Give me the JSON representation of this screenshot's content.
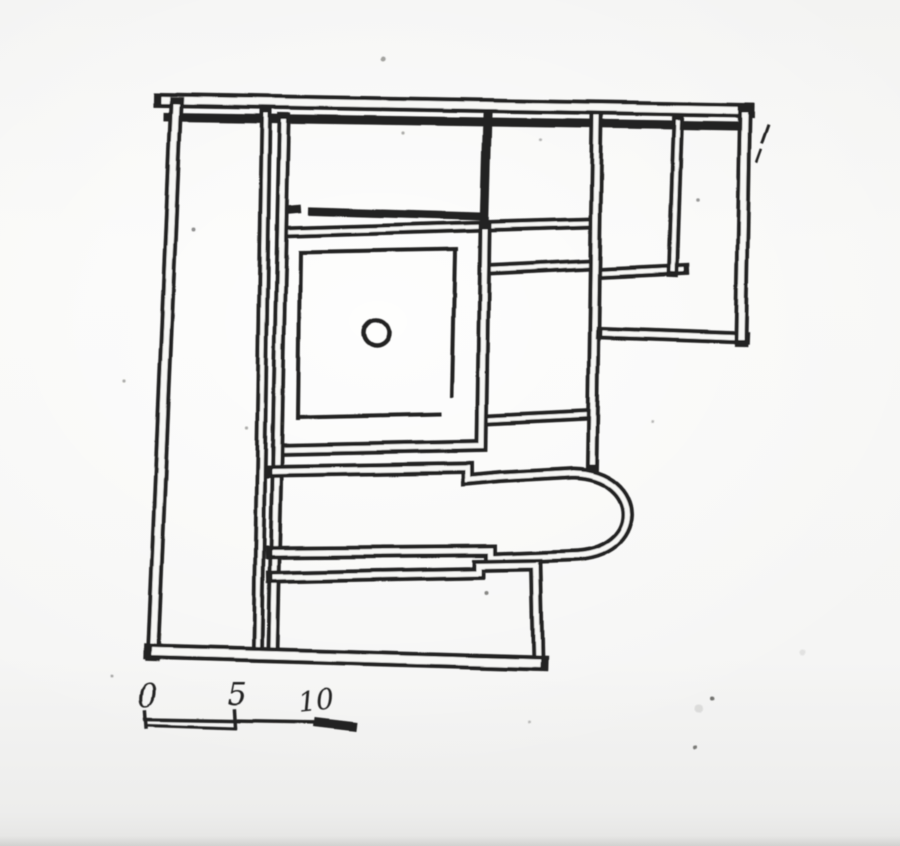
{
  "figure": {
    "kind": "scanned hand-drawn building floor plan",
    "paper_color": "#f7f7f5",
    "ink_color": "#242322"
  },
  "scale_bar": {
    "labels": [
      {
        "text": "0",
        "x": 149,
        "y": 706,
        "size": 31,
        "rot": -4
      },
      {
        "text": "5",
        "x": 238,
        "y": 705,
        "size": 31,
        "rot": 0
      },
      {
        "text": "10",
        "x": 316,
        "y": 710,
        "size": 28,
        "rot": -6
      }
    ],
    "lines": [
      {
        "d": "M 146,711 L 147,727",
        "w": 3.5
      },
      {
        "d": "M 235,711 L 236,727",
        "w": 3.5
      },
      {
        "d": "M 146,719 L 320,722",
        "w": 3.5
      },
      {
        "d": "M 147,725 L 236,728",
        "w": 3
      },
      {
        "d": "M 318,722 L 352,726",
        "w": 9
      }
    ]
  },
  "plan": {
    "walls": [
      {
        "d": "M 168,117 L 741,126",
        "w": 9,
        "h": 0
      },
      {
        "d": "M 487,115 L 484,229",
        "w": 9,
        "h": 0
      },
      {
        "d": "M 285,210 L 297,209",
        "w": 8,
        "h": 0
      },
      {
        "d": "M 312,211 L 481,216",
        "w": 8,
        "h": 0
      },
      {
        "d": "M 282,232 L 592,223",
        "w": 12,
        "h": 4
      },
      {
        "d": "M 489,269 L 592,264",
        "w": 12,
        "h": 4
      },
      {
        "d": "M 600,273 L 684,269",
        "w": 12,
        "h": 4
      },
      {
        "d": "M 678,120 L 673,271",
        "w": 12,
        "h": 4
      },
      {
        "d": "M 488,420 L 589,415",
        "w": 12,
        "h": 4
      },
      {
        "d": "M 485,229 L 482,446 L 277,450",
        "w": 13,
        "h": 5
      },
      {
        "d": "M 266,113 L 258,648",
        "w": 12,
        "h": 4
      },
      {
        "d": "M 284,119 L 273,651",
        "w": 13,
        "h": 5
      },
      {
        "d": "M 597,115 L 592,464",
        "w": 13,
        "h": 5
      },
      {
        "d": "M 272,471 L 467,468 L 467,480 L 501,477 L 573,473 C 646,475 646,555 571,556 L 491,559 L 491,551 L 272,553",
        "w": 13,
        "h": 5
      },
      {
        "d": "M 273,577 L 479,573 L 479,566 L 536,565 L 538,664",
        "w": 13,
        "h": 5
      },
      {
        "d": "M 743,338 L 602,333",
        "w": 13,
        "h": 5
      },
      {
        "d": "M 161,100 L 747,110",
        "w": 15,
        "h": 7
      },
      {
        "d": "M 745,112 L 741,340",
        "w": 14,
        "h": 6
      },
      {
        "d": "M 176,104 L 153,655",
        "w": 14,
        "h": 6
      },
      {
        "d": "M 152,652 L 540,663",
        "w": 16,
        "h": 8
      }
    ],
    "single_lines": [
      {
        "d": "M 301,252 L 456,249",
        "w": 4
      },
      {
        "d": "M 300,252 L 298,418",
        "w": 4
      },
      {
        "d": "M 455,251 L 452,396",
        "w": 4
      },
      {
        "d": "M 299,417 L 439,414",
        "w": 4
      },
      {
        "d": "M 768,126 L 762,143",
        "w": 3
      },
      {
        "d": "M 761,151 L 757,162",
        "w": 2.5
      }
    ],
    "well_circle": {
      "cx": 376,
      "cy": 333,
      "r": 13,
      "w": 4.5
    },
    "specks": [
      {
        "x": 383,
        "y": 59,
        "r": 2.5,
        "o": 0.45
      },
      {
        "x": 403,
        "y": 133,
        "r": 1.6,
        "o": 0.4
      },
      {
        "x": 541,
        "y": 140,
        "r": 1.6,
        "o": 0.35
      },
      {
        "x": 193,
        "y": 229,
        "r": 2,
        "o": 0.55
      },
      {
        "x": 698,
        "y": 200,
        "r": 1.8,
        "o": 0.5
      },
      {
        "x": 287,
        "y": 258,
        "r": 1.5,
        "o": 0.35
      },
      {
        "x": 282,
        "y": 423,
        "r": 1.8,
        "o": 0.45
      },
      {
        "x": 124,
        "y": 381,
        "r": 1.6,
        "o": 0.4
      },
      {
        "x": 247,
        "y": 427,
        "r": 1.6,
        "o": 0.4
      },
      {
        "x": 652,
        "y": 422,
        "r": 1.5,
        "o": 0.35
      },
      {
        "x": 487,
        "y": 593,
        "r": 2,
        "o": 0.6
      },
      {
        "x": 713,
        "y": 698,
        "r": 2,
        "o": 0.7
      },
      {
        "x": 695,
        "y": 747,
        "r": 2,
        "o": 0.65
      },
      {
        "x": 700,
        "y": 708,
        "r": 4,
        "o": 0.12
      },
      {
        "x": 803,
        "y": 653,
        "r": 3,
        "o": 0.1
      },
      {
        "x": 112,
        "y": 676,
        "r": 1.5,
        "o": 0.4
      },
      {
        "x": 529,
        "y": 722,
        "r": 1.5,
        "o": 0.3
      }
    ]
  }
}
